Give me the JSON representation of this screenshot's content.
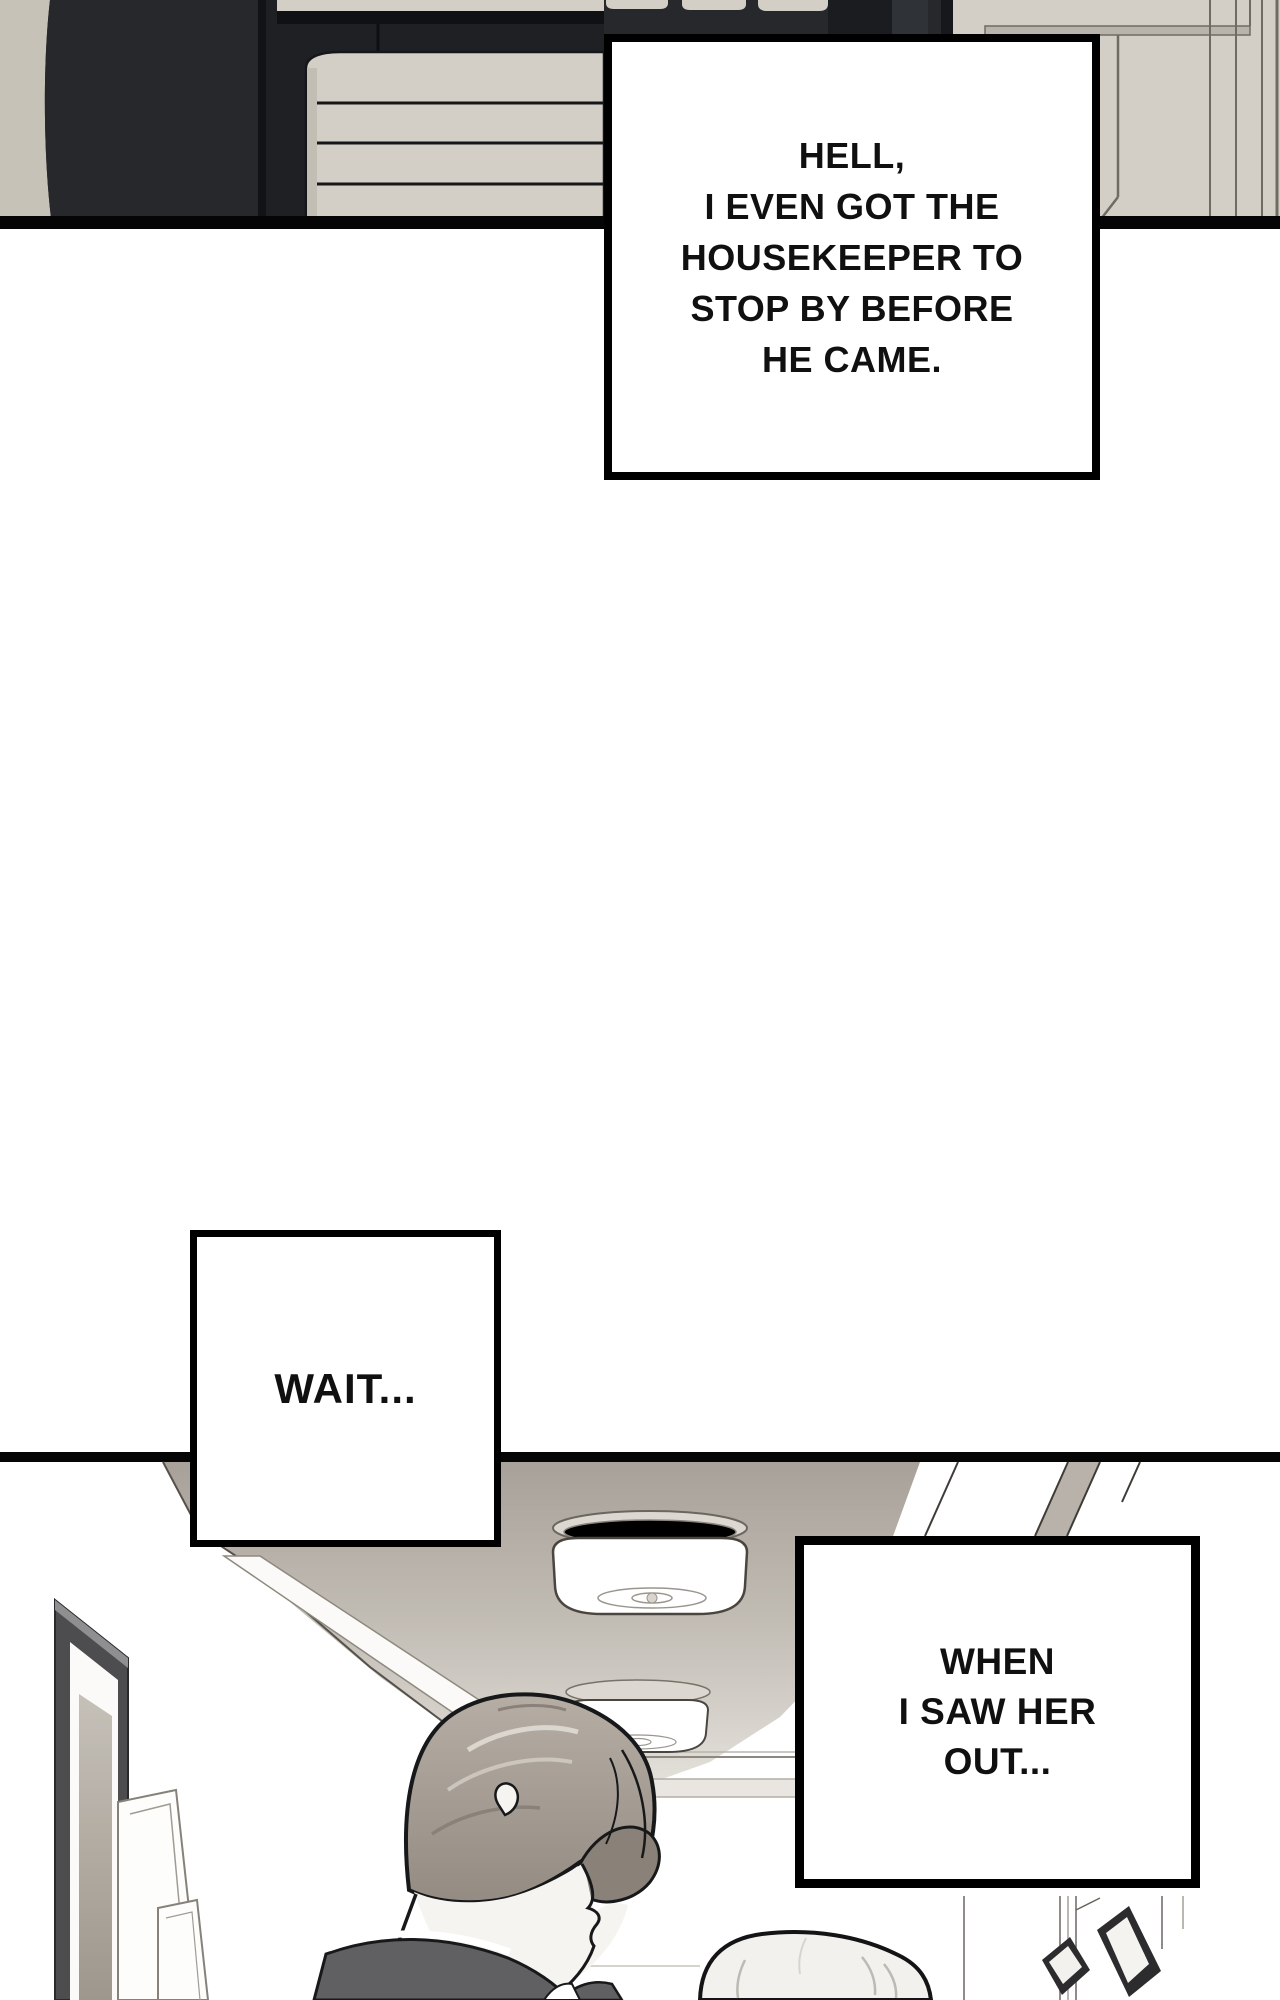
{
  "page": {
    "width": 1280,
    "height": 2000,
    "background": "#ffffff",
    "kind": "webtoon-comic-page"
  },
  "captions": {
    "housekeeper": {
      "lines": [
        "HELL,",
        "I EVEN GOT THE",
        "HOUSEKEEPER TO",
        "STOP BY BEFORE",
        "HE CAME."
      ]
    },
    "wait": {
      "lines": [
        "WAIT..."
      ]
    },
    "saw_her_out": {
      "lines": [
        "WHEN",
        "I SAW HER",
        "OUT..."
      ]
    }
  },
  "colors": {
    "caption_bg": "#ffffff",
    "caption_border": "#000000",
    "caption_text": "#101010",
    "panel_border": "#050505",
    "wardrobe_door": "#26282c",
    "wardrobe_interior": "#1e2024",
    "wardrobe_divider": "#121317",
    "shelf_shadow": "#101114",
    "towel": "#d4cfc6",
    "towel_edge": "#15161a",
    "left_wall_beige": "#c7c2b8",
    "side_wall_beige": "#d3cfc6",
    "wall_line": "#6f6b63",
    "ceiling_top": "#a8a199",
    "ceiling_mid": "#c2bdb5",
    "ceiling_bottom": "#e4e1db",
    "lamp_rim": "#dcd8d1",
    "lamp_outline": "#4a463f",
    "hair_base": "#aaa298",
    "hair_shadow": "#8a8278",
    "hair_light": "#e3ded7",
    "skin": "#f6f4f0",
    "line_art": "#17181a",
    "suit": "#606063",
    "shirt": "#ffffff",
    "frame_dark": "#4d4d50",
    "frame_mat_light": "#c6c1b8",
    "frame_mat_dark": "#9d978d",
    "frame_black": "#2c2c2e",
    "white_hair": "#f2f1ee",
    "hair_strand": "#bdbab3",
    "wainscot": "#e9e6e1"
  }
}
